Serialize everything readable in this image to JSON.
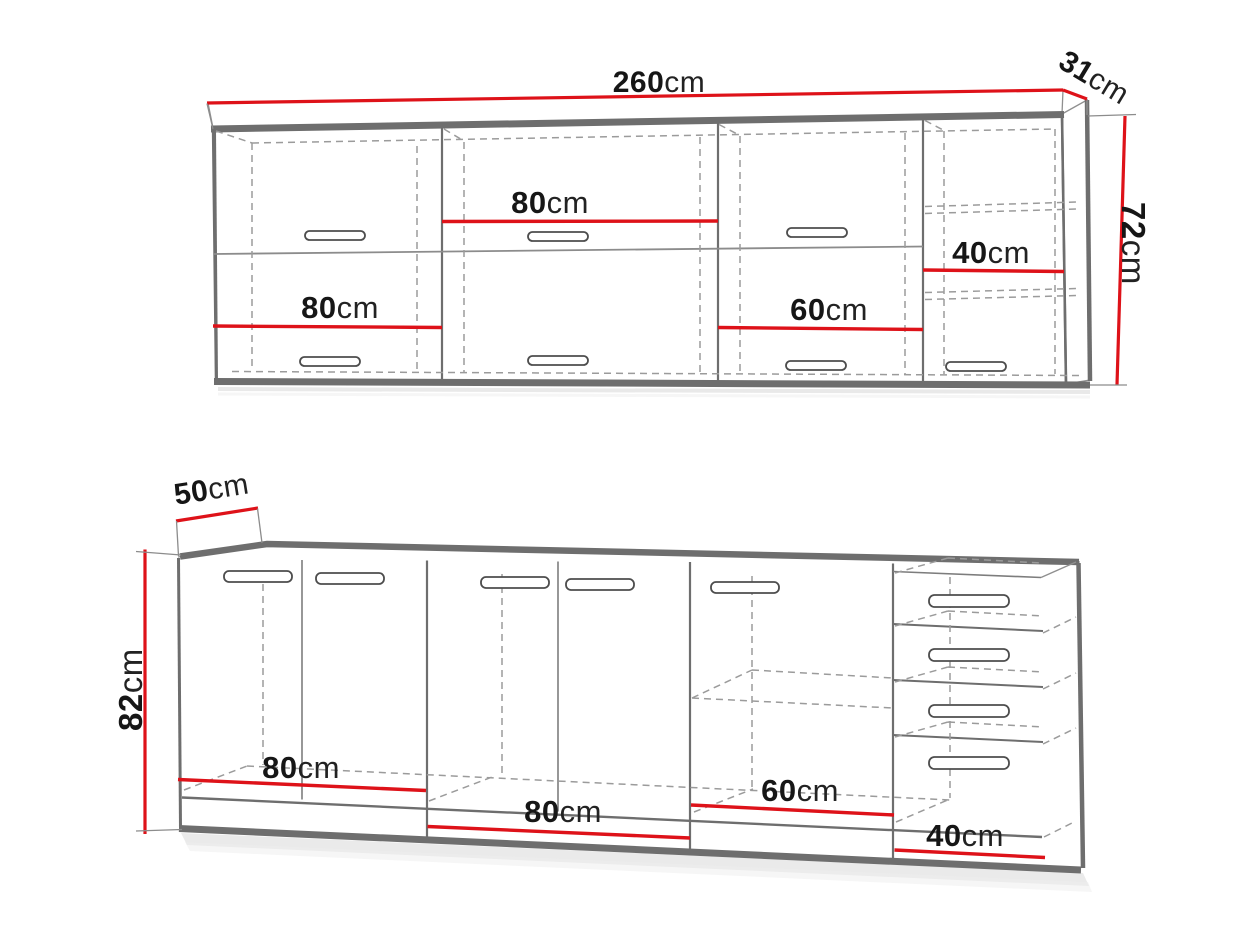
{
  "diagram": {
    "type": "kitchen-cabinet-dimension-drawing",
    "views": [
      "wall-cabinets-row",
      "base-cabinets-row"
    ],
    "wall_unit": {
      "total_width_cm": 260,
      "depth_cm": 31,
      "height_cm": 72,
      "cabinet_widths_cm": [
        80,
        80,
        60,
        40
      ]
    },
    "base_unit": {
      "depth_cm": 50,
      "height_cm": 82,
      "cabinet_widths_cm": [
        80,
        80,
        60,
        40
      ]
    }
  },
  "labels": {
    "wall_width_num": "260",
    "wall_width_unit": "cm",
    "wall_depth_num": "31",
    "wall_depth_unit": "cm",
    "wall_height_num": "72",
    "wall_height_unit": "cm",
    "wall_cab1_num": "80",
    "wall_cab1_unit": "cm",
    "wall_cab2_num": "80",
    "wall_cab2_unit": "cm",
    "wall_cab3_num": "60",
    "wall_cab3_unit": "cm",
    "wall_cab4_num": "40",
    "wall_cab4_unit": "cm",
    "base_depth_num": "50",
    "base_depth_unit": "cm",
    "base_height_num": "82",
    "base_height_unit": "cm",
    "base_cab1_num": "80",
    "base_cab1_unit": "cm",
    "base_cab2_num": "80",
    "base_cab2_unit": "cm",
    "base_cab3_num": "60",
    "base_cab3_unit": "cm",
    "base_cab4_num": "40",
    "base_cab4_unit": "cm"
  },
  "colors": {
    "dimension_red": "#de1219",
    "outline_gray": "#6f6f6f",
    "dashed_gray": "#9b9b9b",
    "label_black": "#161616"
  }
}
